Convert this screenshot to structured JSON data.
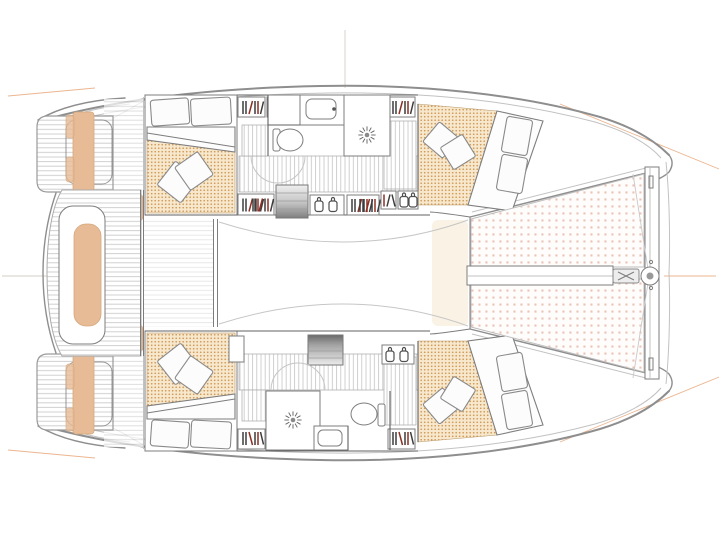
{
  "page": {
    "type": "boat-floorplan",
    "vessel": "catamaran",
    "view": "top-down interior deck plan",
    "bow_direction": "right",
    "visible_text": ""
  },
  "colors": {
    "background": "#ffffff",
    "hull_line": "#8e8e8e",
    "inner_line": "#c2c2c2",
    "wall_line": "#606060",
    "furniture_line": "#7d7d7d",
    "teak_line": "#cccccc",
    "plank_line": "#c4c4c4",
    "stipple_bg": "#f7e8cd",
    "stipple_dot": "#cf9a58",
    "tramp_bg": "#fffdfc",
    "tramp_dot": "#dd9e8a",
    "cushion_tan": "#e7bb95",
    "cushion_tan_edge": "#d6a87e",
    "book_dark": "#3c3c3c",
    "book_red": "#8d2f23",
    "reference_orange": "#e7a87d",
    "reference_gray": "#d5cdc5",
    "glow_warm": "#f8efdf"
  },
  "layout": {
    "port_hull_rooms": [
      "aft-cabin",
      "head-with-shower",
      "forward-cabin"
    ],
    "starboard_hull_rooms": [
      "aft-cabin",
      "head-with-shower",
      "forward-cabin"
    ],
    "deck_areas": [
      "swim-platform-port",
      "swim-platform-starboard",
      "aft-cockpit",
      "saloon",
      "trampoline",
      "bowsprit"
    ]
  },
  "icons": [
    "shower-drain-icon",
    "toilet-icon",
    "sink-icon",
    "books-shelf-icon",
    "jar-icon",
    "hanging-locker-icon",
    "companionway-steps",
    "trampoline-mesh",
    "bowsprit-ring-icon",
    "bed",
    "pillow",
    "throw-cushion",
    "cockpit-bench",
    "swim-platform",
    "crossbeam",
    "centerline-mark",
    "mast-station-line"
  ]
}
